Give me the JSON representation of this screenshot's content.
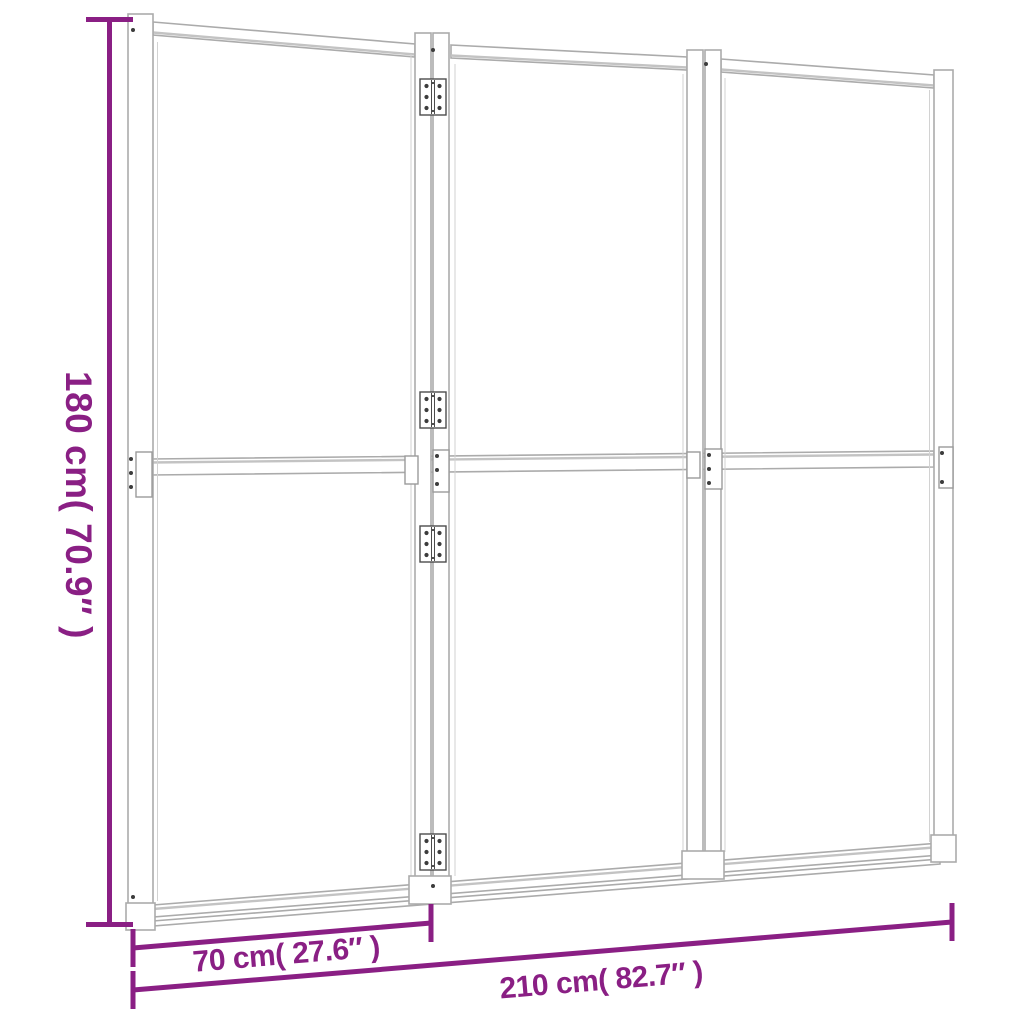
{
  "figure": {
    "name": "3-panel-room-divider-dimension-diagram",
    "panel_count_visible": 3,
    "hinge_count_visible": 4
  },
  "dimension_labels": {
    "height": "180 cm( 70.9″ )",
    "panel_width": "70 cm( 27.6″ )",
    "total_width": "210 cm( 82.7″ )"
  },
  "style": {
    "dimension_color": "#8A1F84",
    "frame_line_color": "#ABABAB",
    "hinge_line_color": "#4C4C4C",
    "background_color": "#FFFFFF"
  }
}
